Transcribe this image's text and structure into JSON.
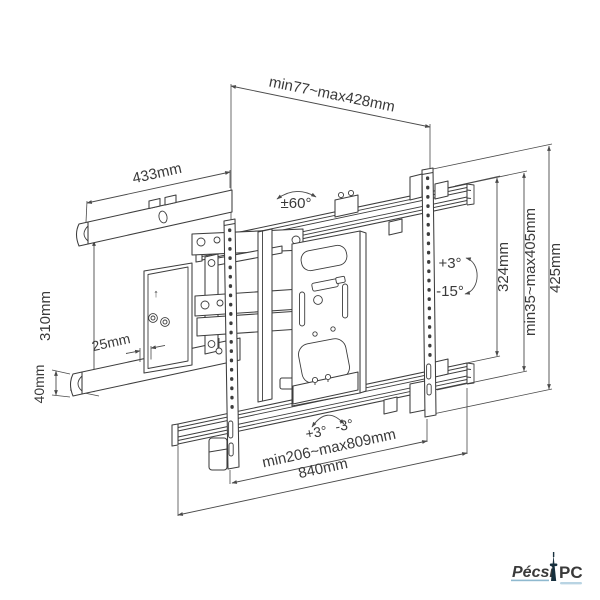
{
  "annotations": {
    "depth_range": "min77~max428mm",
    "arm_length": "433mm",
    "swivel": "±60°",
    "wall_plate_height": "310mm",
    "offset_step": "25mm",
    "arm_height": "40mm",
    "tilt_up": "+3°",
    "tilt_down": "-15°",
    "inner_height": "324mm",
    "vertical_range": "min35~max405mm",
    "bracket_height": "425mm",
    "level_plus": "+3°",
    "level_minus": "-3°",
    "slide_range": "min206~max809mm",
    "rail_width": "840mm"
  },
  "icons": {
    "keyhole_arrow": "↑"
  },
  "logo": {
    "brand_first": "Pécsi",
    "brand_second": "PC",
    "color_first": "#8fb9cf",
    "color_second": "#447fa3",
    "tower_color": "#17303e"
  },
  "colors": {
    "line": "#3d3d3d",
    "dimension": "#4a4a4a",
    "background": "#ffffff"
  }
}
